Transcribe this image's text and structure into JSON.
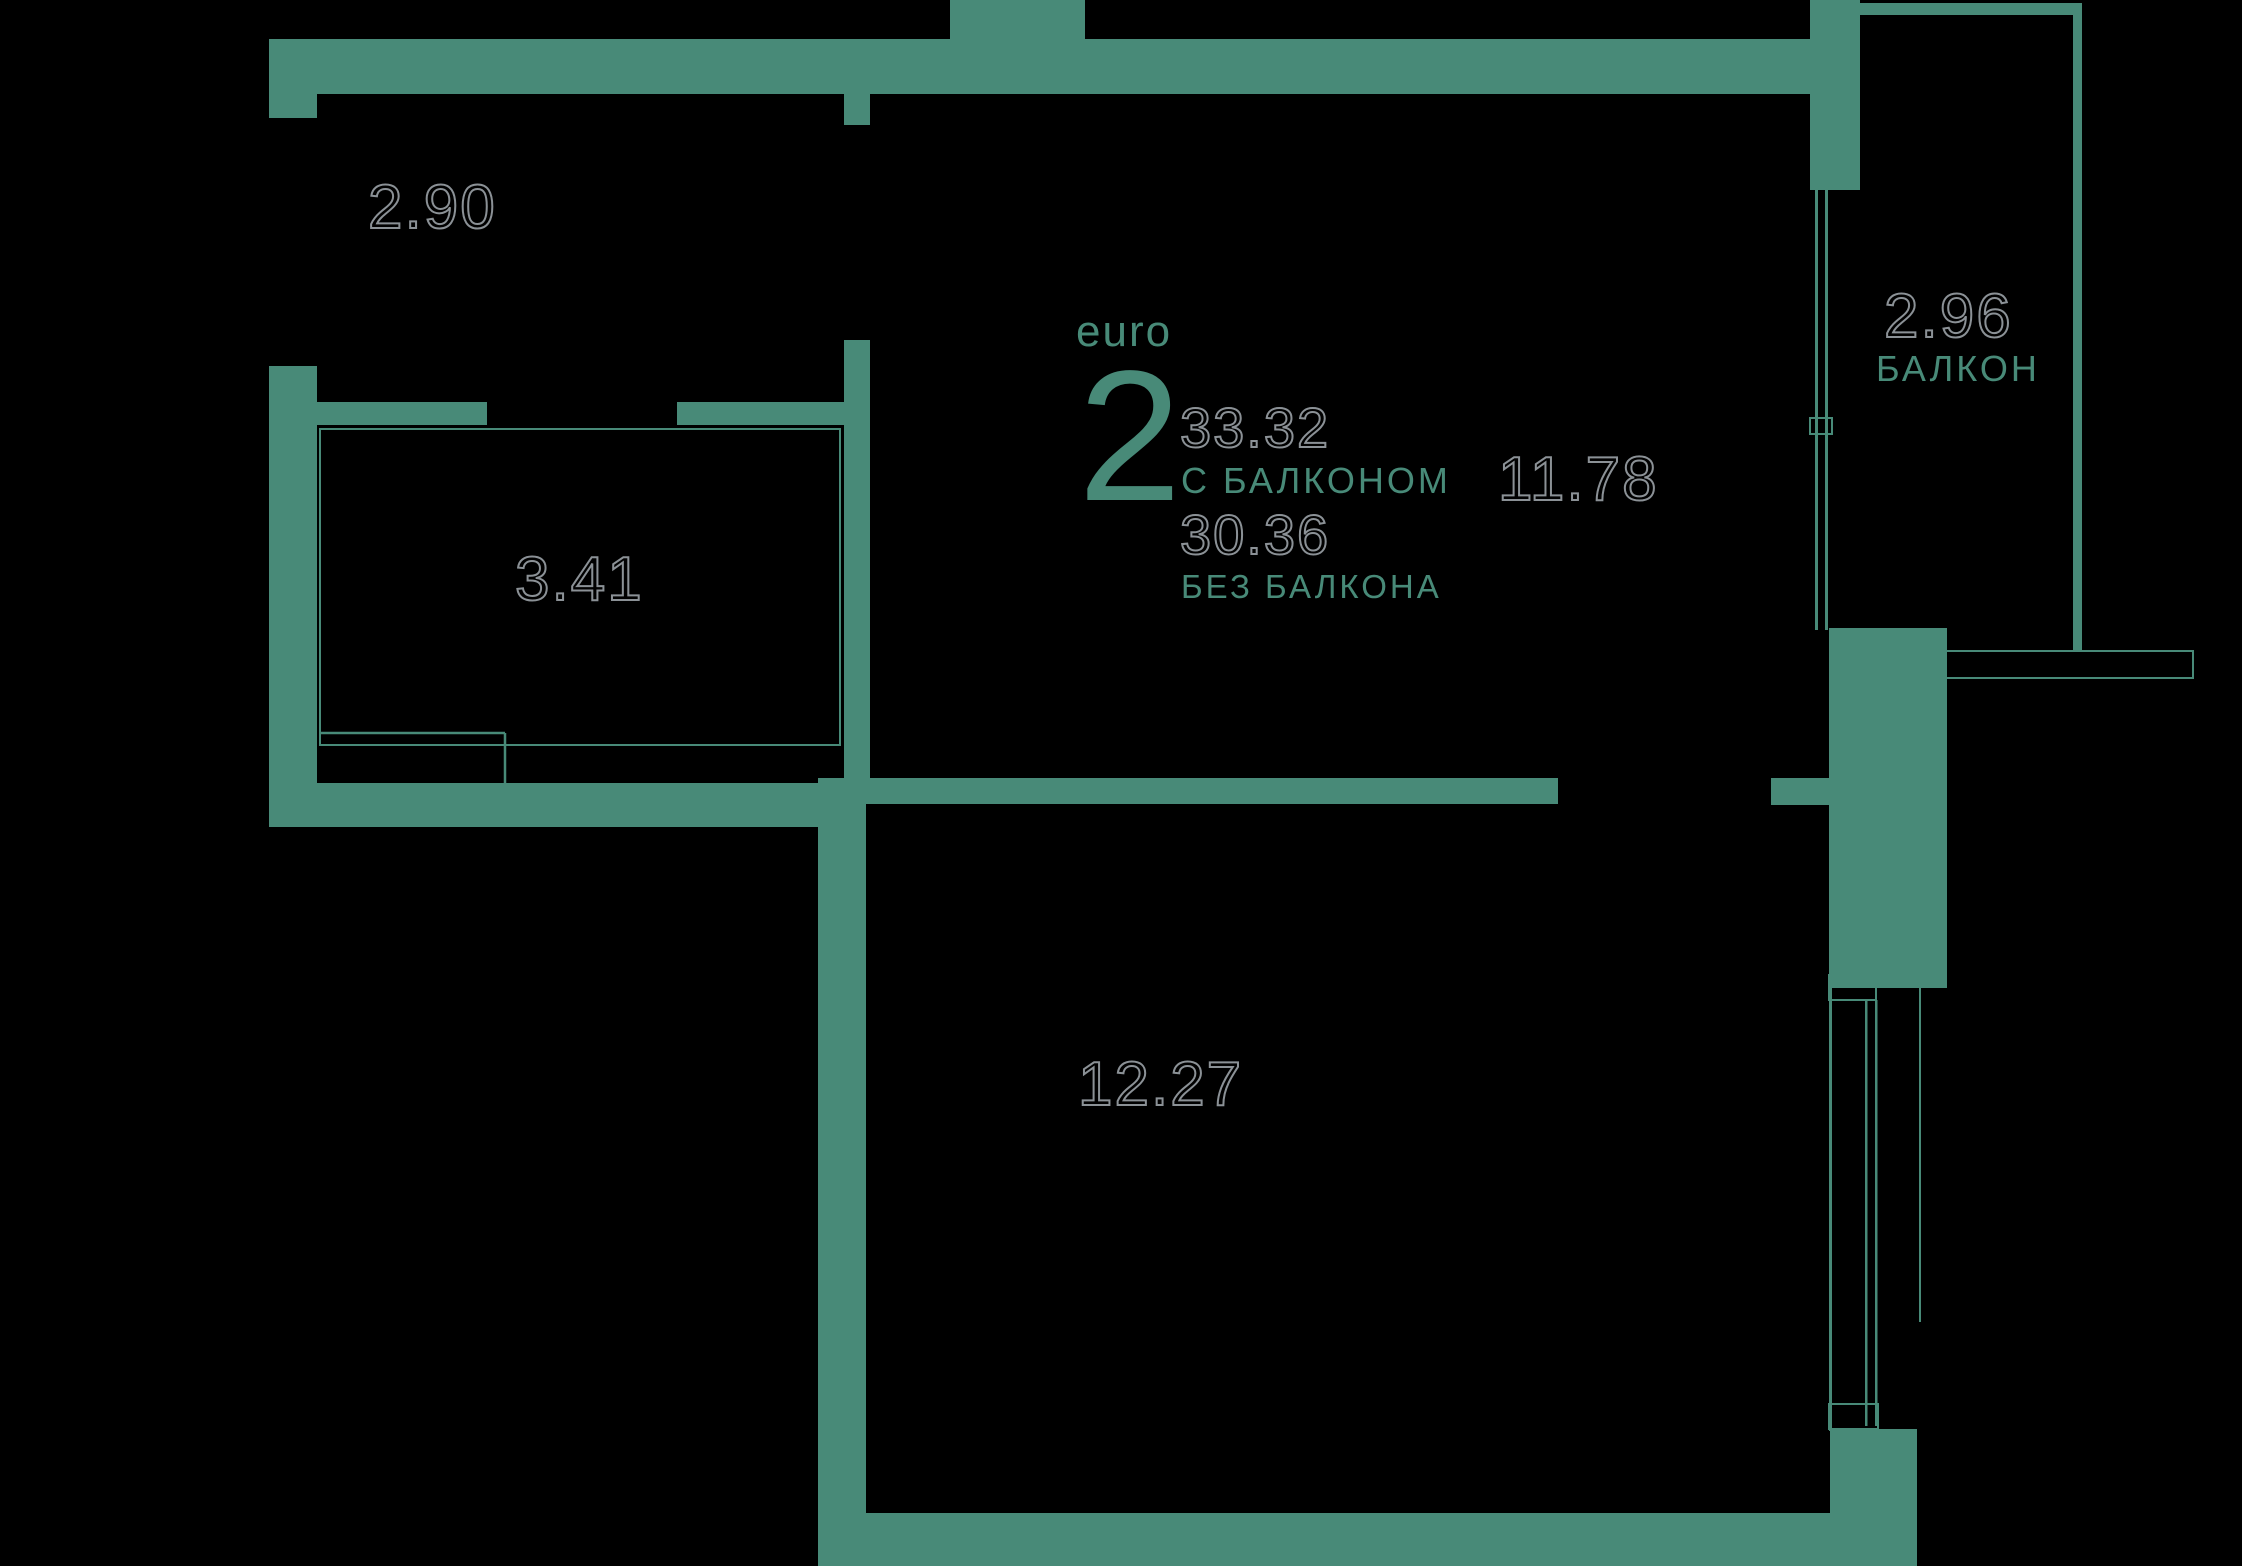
{
  "colors": {
    "wall": "#488a78",
    "background": "#000000",
    "outline_text": "#8b9196",
    "accent_text": "#488a78"
  },
  "unit_badge": {
    "type_label": "euro",
    "rooms_count": "2",
    "area_with_balcony": "33.32",
    "with_balcony_label": "С БАЛКОНОМ",
    "area_without_balcony": "30.36",
    "without_balcony_label": "БЕЗ БАЛКОНА"
  },
  "rooms": {
    "hallway": {
      "area": "2.90"
    },
    "bathroom": {
      "area": "3.41"
    },
    "living": {
      "area": "11.78"
    },
    "bedroom": {
      "area": "12.27"
    },
    "balcony": {
      "area": "2.96",
      "label": "БАЛКОН"
    }
  }
}
